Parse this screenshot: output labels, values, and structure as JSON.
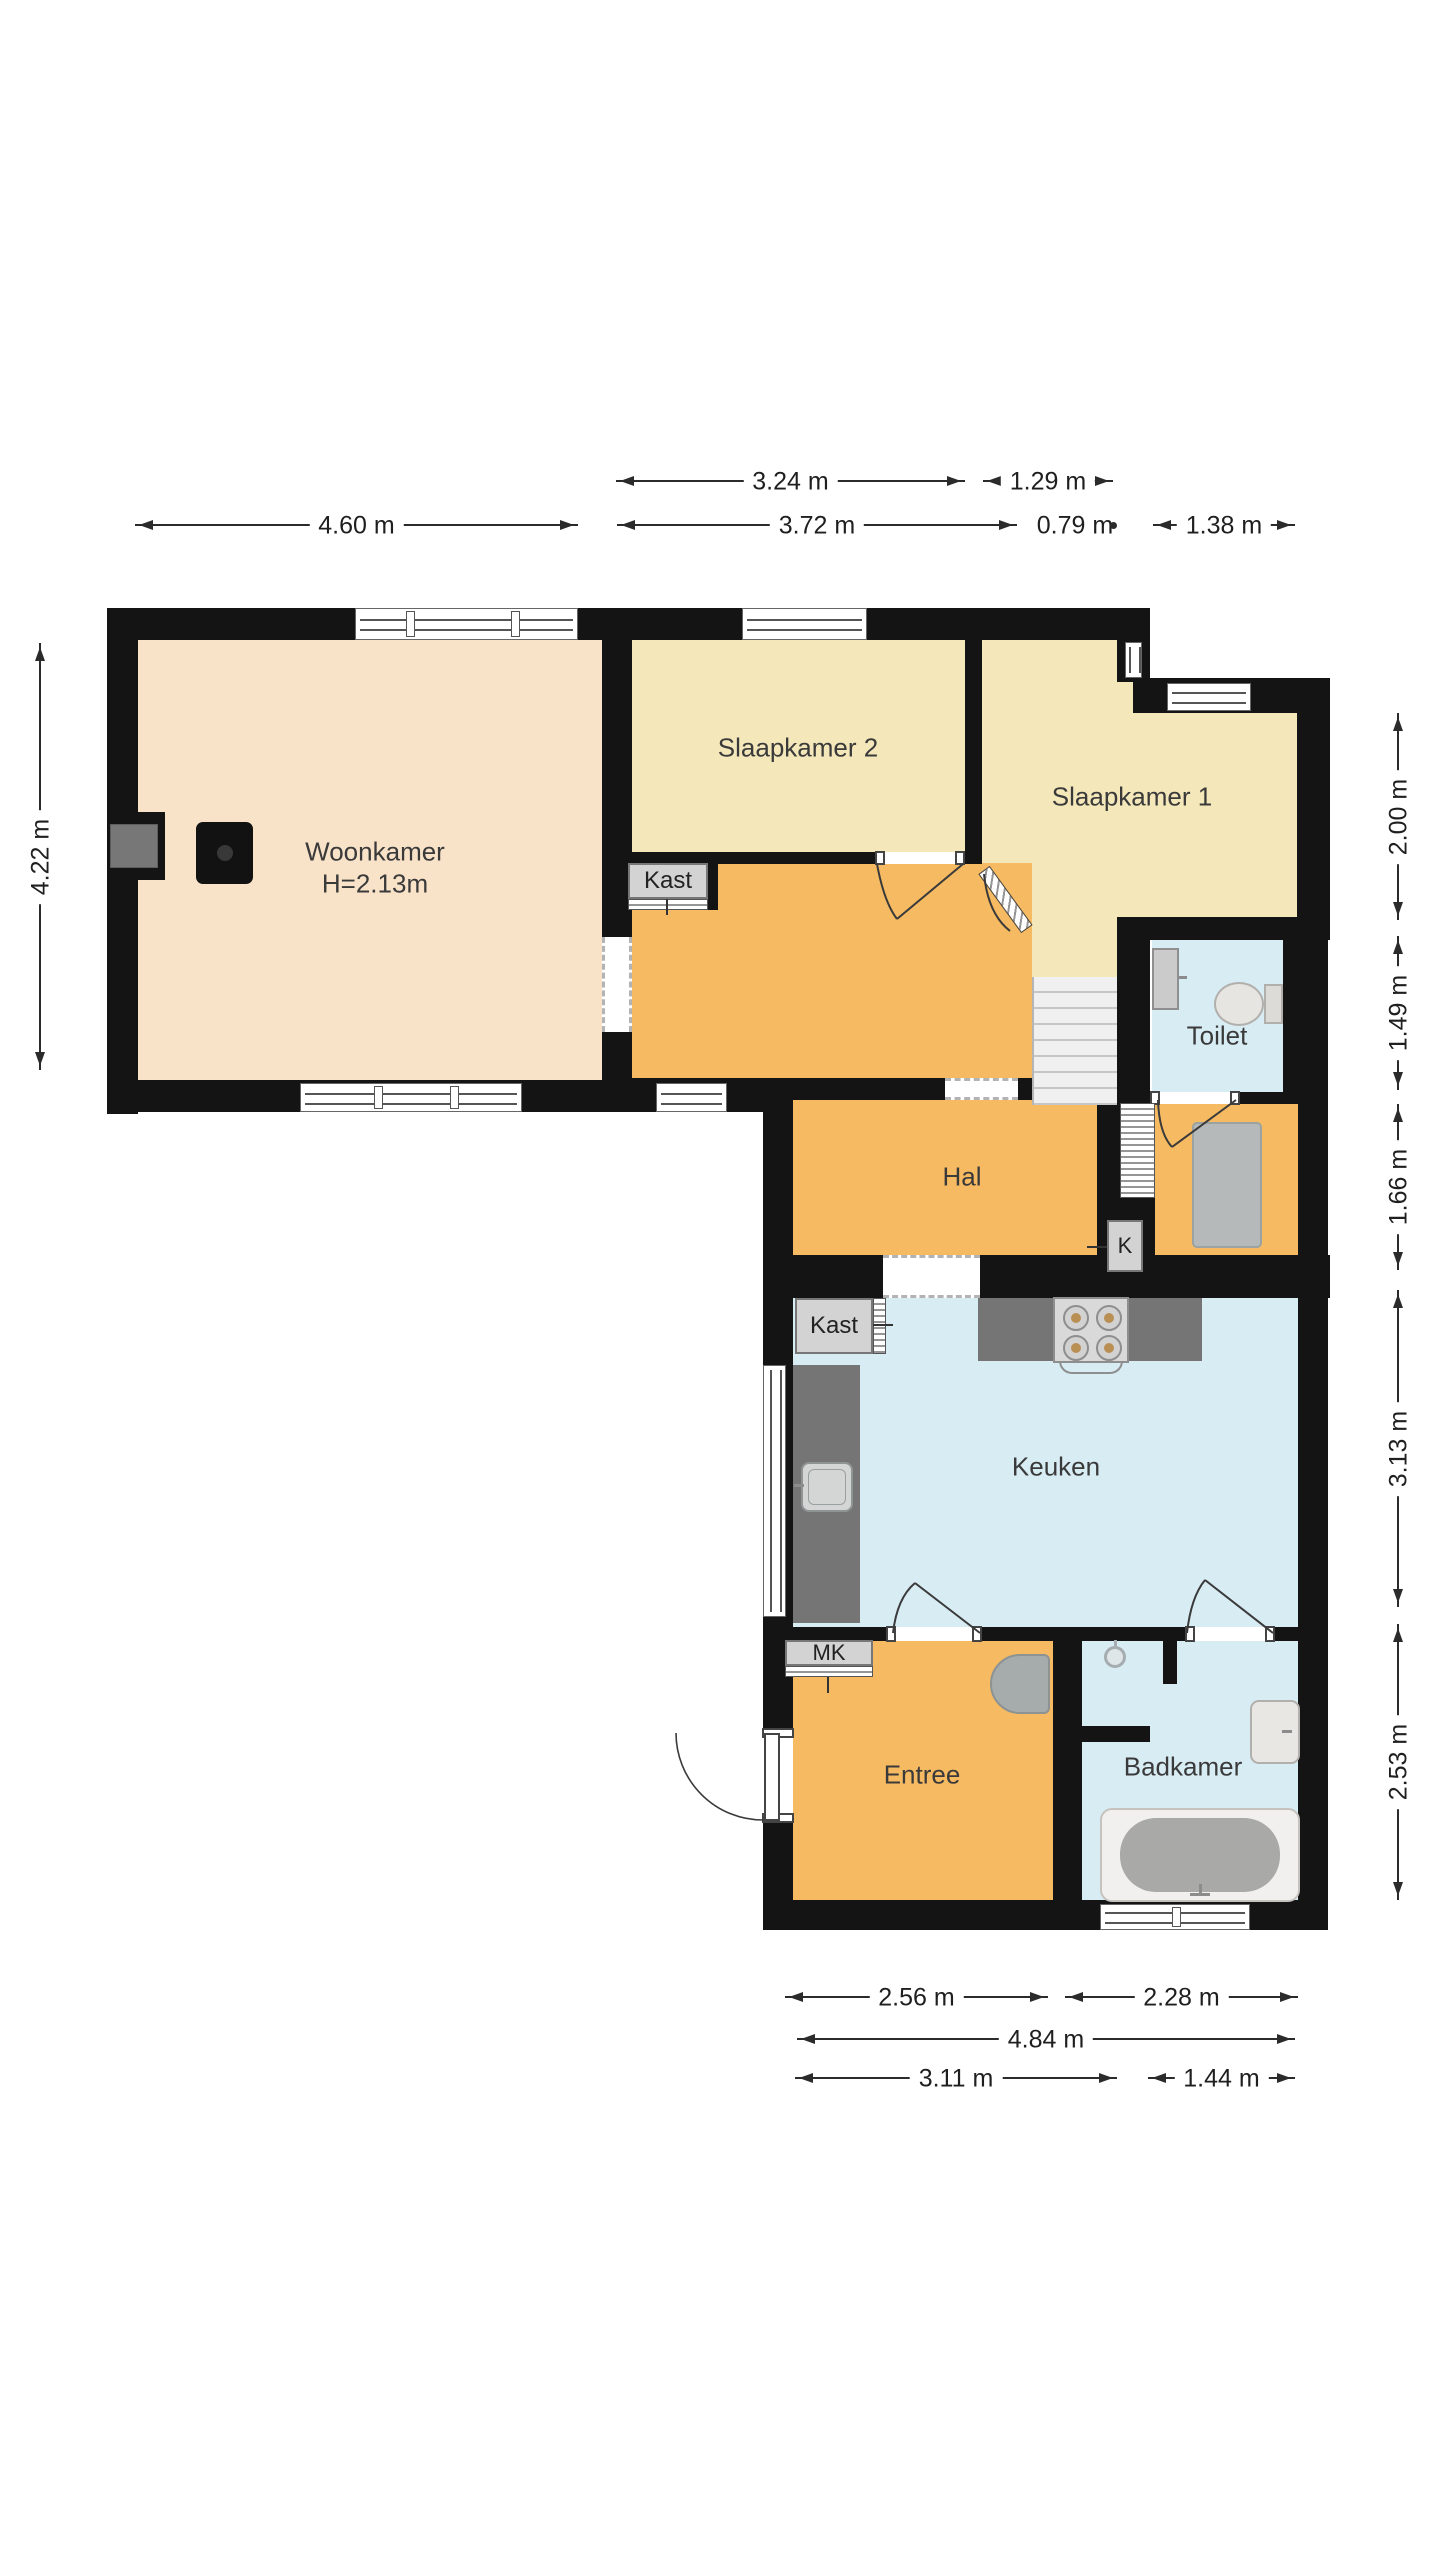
{
  "rooms": {
    "woonkamer": {
      "label": "Woonkamer",
      "height_label": "H=2.13m"
    },
    "slaapkamer2": {
      "label": "Slaapkamer 2"
    },
    "slaapkamer1": {
      "label": "Slaapkamer 1"
    },
    "toilet": {
      "label": "Toilet"
    },
    "hal": {
      "label": "Hal"
    },
    "keuken": {
      "label": "Keuken"
    },
    "entree": {
      "label": "Entree"
    },
    "badkamer": {
      "label": "Badkamer"
    }
  },
  "closets": {
    "kast_boven": {
      "label": "Kast"
    },
    "kast_hal": {
      "label": "Kast"
    },
    "meterkast": {
      "label": "MK"
    },
    "k_kast": {
      "label": "K"
    }
  },
  "dims": {
    "d324": {
      "label": "3.24 m"
    },
    "d129": {
      "label": "1.29 m"
    },
    "d460": {
      "label": "4.60 m"
    },
    "d372": {
      "label": "3.72 m"
    },
    "d079": {
      "label": "0.79 m"
    },
    "d138": {
      "label": "1.38 m"
    },
    "d422": {
      "label": "4.22 m"
    },
    "d200": {
      "label": "2.00 m"
    },
    "d149": {
      "label": "1.49 m"
    },
    "d166": {
      "label": "1.66 m"
    },
    "d313": {
      "label": "3.13 m"
    },
    "d253": {
      "label": "2.53 m"
    },
    "d256": {
      "label": "2.56 m"
    },
    "d228": {
      "label": "2.28 m"
    },
    "d484": {
      "label": "4.84 m"
    },
    "d311": {
      "label": "3.11 m"
    },
    "d144": {
      "label": "1.44 m"
    }
  },
  "colors": {
    "wall": "#141414",
    "living_floor": "#f8e3c8",
    "bedroom_floor": "#f4e7ba",
    "hall_floor": "#f6ba62",
    "wet_floor": "#d8ecf4",
    "counter": "#757575",
    "closet_fill": "#d3d3d3",
    "fixture_fill": "#e6e5e2",
    "dim_text": "#1f1f1f"
  },
  "icons": {
    "stairs-icon": "staircase treads",
    "stove-icon": "4-burner cooktop",
    "kitchen-sink-icon": "kitchen sink",
    "toilet-icon": "toilet bowl with cistern",
    "toilet-sink-icon": "small hand basin",
    "bath-icon": "bathtub",
    "shower-icon": "shower head",
    "washbasin-icon": "washbasin",
    "chimney-icon": "chimney block",
    "mat-icon": "floor mat",
    "window-icon": "window with double frame",
    "door-swing-icon": "door leaf with swing arc"
  }
}
